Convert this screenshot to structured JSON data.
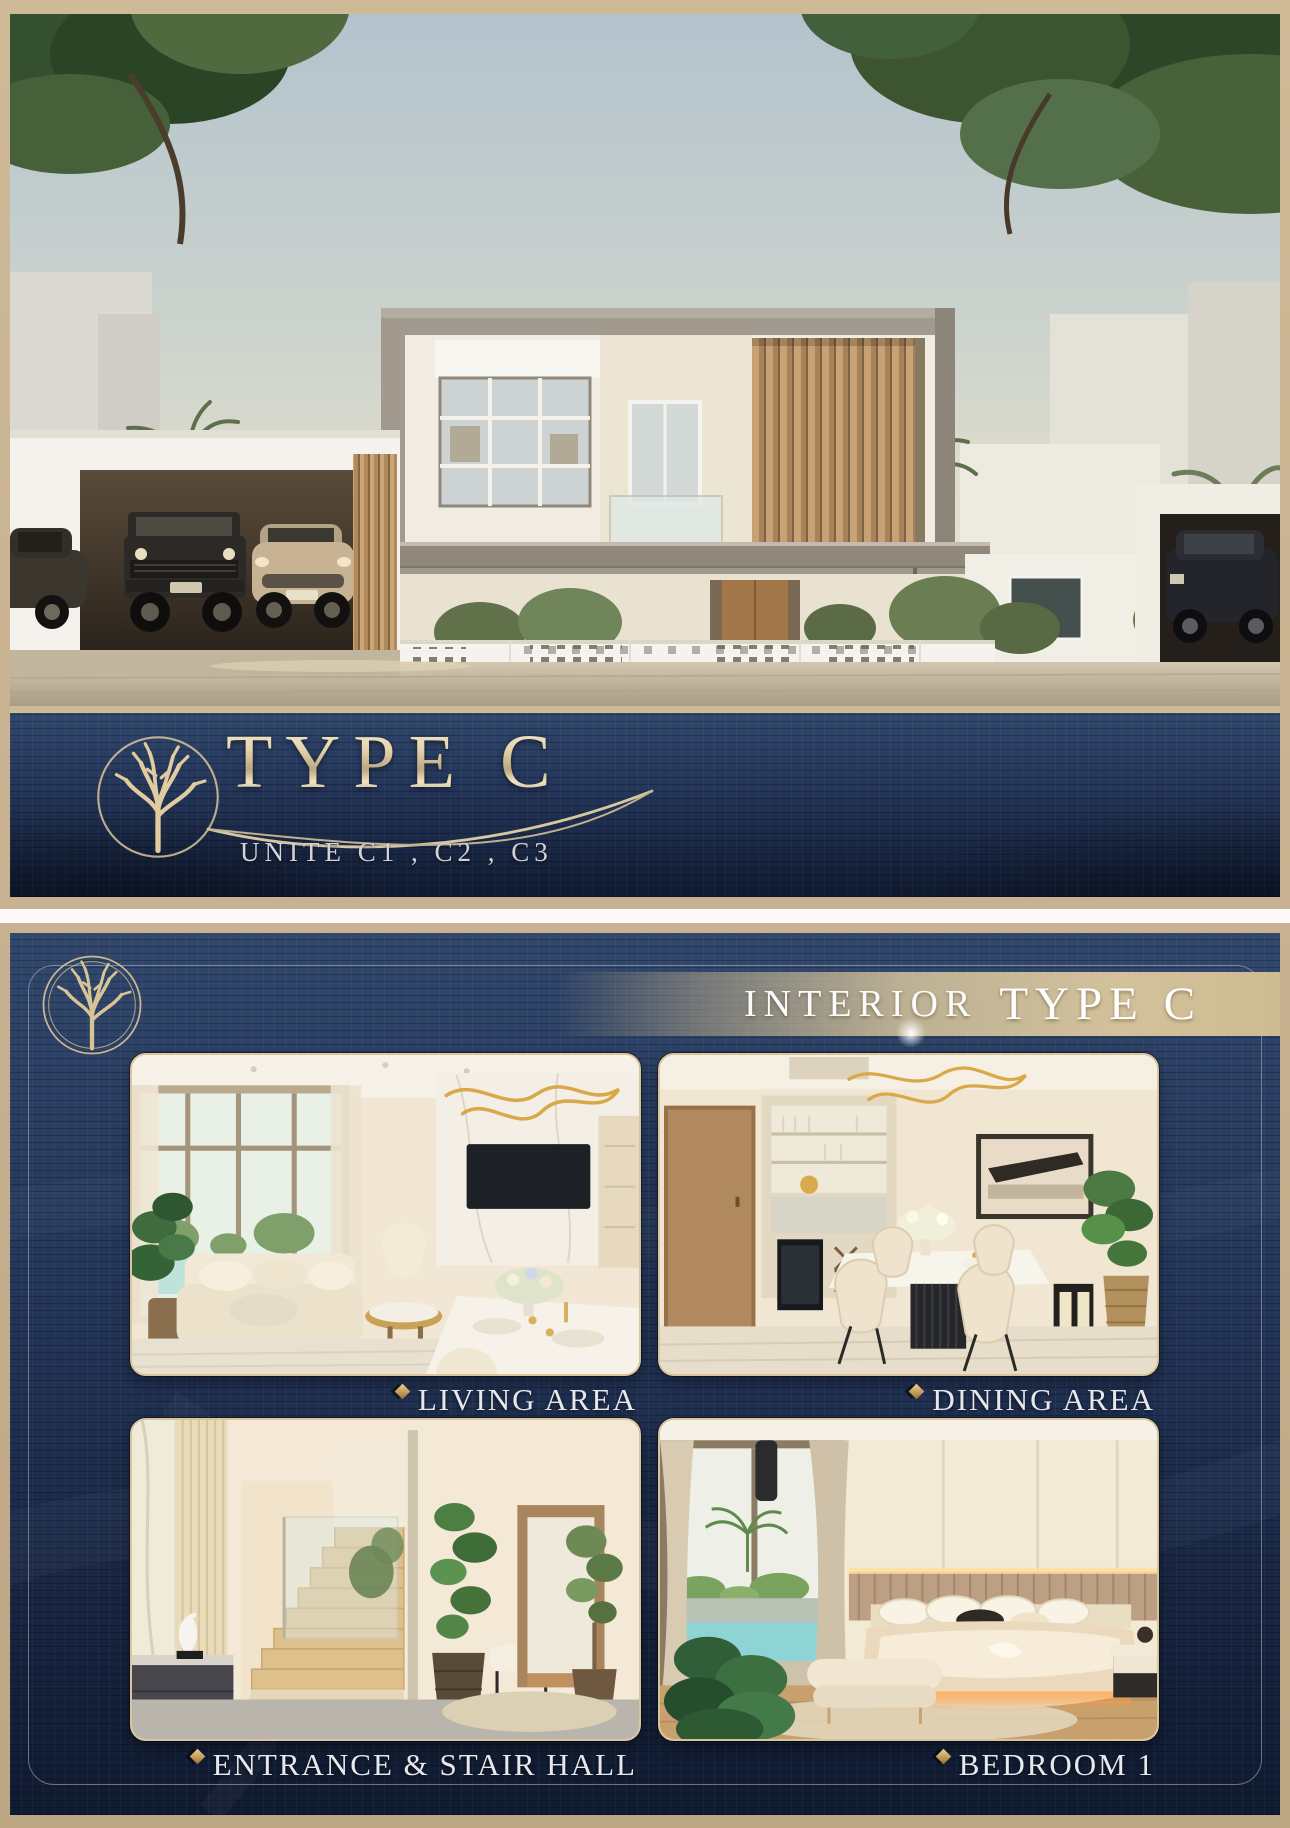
{
  "exterior_panel": {
    "logo": "tree-in-circle",
    "title": "TYPE C",
    "subtitle": "UNITE  C1 , C2 , C3"
  },
  "interior_panel": {
    "logo": "tree-in-double-circle",
    "header": {
      "prefix": "INTERIOR",
      "main": "TYPE C"
    },
    "photos": [
      {
        "caption": "LIVING AREA"
      },
      {
        "caption": "DINING AREA"
      },
      {
        "caption": "ENTRANCE & STAIR HALL"
      },
      {
        "caption": "BEDROOM 1"
      }
    ]
  },
  "colors": {
    "navy_panel": "#22355a",
    "navy_dark": "#101b31",
    "tan_background": "#c7b190",
    "gold_accent": "#c9a96a",
    "champagne_text": "#dcc89b",
    "silver_text": "#d2d2d8",
    "caption_text": "#e7e8ec",
    "photo_border": "#d9c49c"
  }
}
